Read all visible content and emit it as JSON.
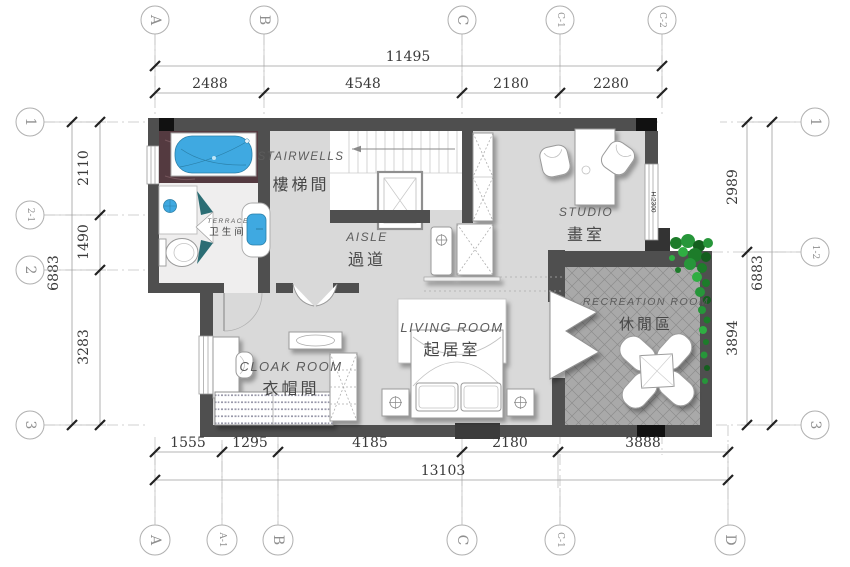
{
  "drawing_title": "residential floor plan",
  "grid": {
    "top": [
      "A",
      "B",
      "C",
      "C-1",
      "C-2"
    ],
    "bottom": [
      "A",
      "A-1",
      "B",
      "C",
      "C-1",
      "D"
    ],
    "left": [
      "1",
      "2-1",
      "2",
      "3"
    ],
    "right": [
      "1",
      "1-2",
      "3"
    ]
  },
  "dims": {
    "top": {
      "total": "11495",
      "segments": [
        "2488",
        "4548",
        "2180",
        "2280"
      ]
    },
    "bottom": {
      "total": "13103",
      "segments": [
        "1555",
        "1295",
        "4185",
        "2180",
        "3888"
      ]
    },
    "left": {
      "total": "6883",
      "segments": [
        "2110",
        "1490",
        "3283"
      ]
    },
    "right": {
      "total": "6883",
      "segments": [
        "2989",
        "3894"
      ]
    }
  },
  "rooms": [
    {
      "en": "STAIRWELLS",
      "zh": "樓梯間"
    },
    {
      "en": "AISLE",
      "zh": "過道"
    },
    {
      "en": "STUDIO",
      "zh": "畫室"
    },
    {
      "en": "LIVING ROOM",
      "zh": "起居室"
    },
    {
      "en": "CLOAK ROOM",
      "zh": "衣帽間"
    },
    {
      "en": "RECREATION ROOM",
      "zh": "休閒區"
    },
    {
      "en": "TERRACE",
      "zh": "卫生间"
    }
  ],
  "annotations": {
    "window_height": "H:2300"
  },
  "colors": {
    "wall": "#4f4f4f",
    "wall_black": "#111111",
    "floor": "#d9d9d9",
    "bath_floor": "#efeeee",
    "recreation_floor": "#a9a9a9",
    "water_fixture": "#3fa9e1",
    "marble_platform": "#543a40",
    "shower_glass": "#2b6d74",
    "plant": "#27963a"
  }
}
